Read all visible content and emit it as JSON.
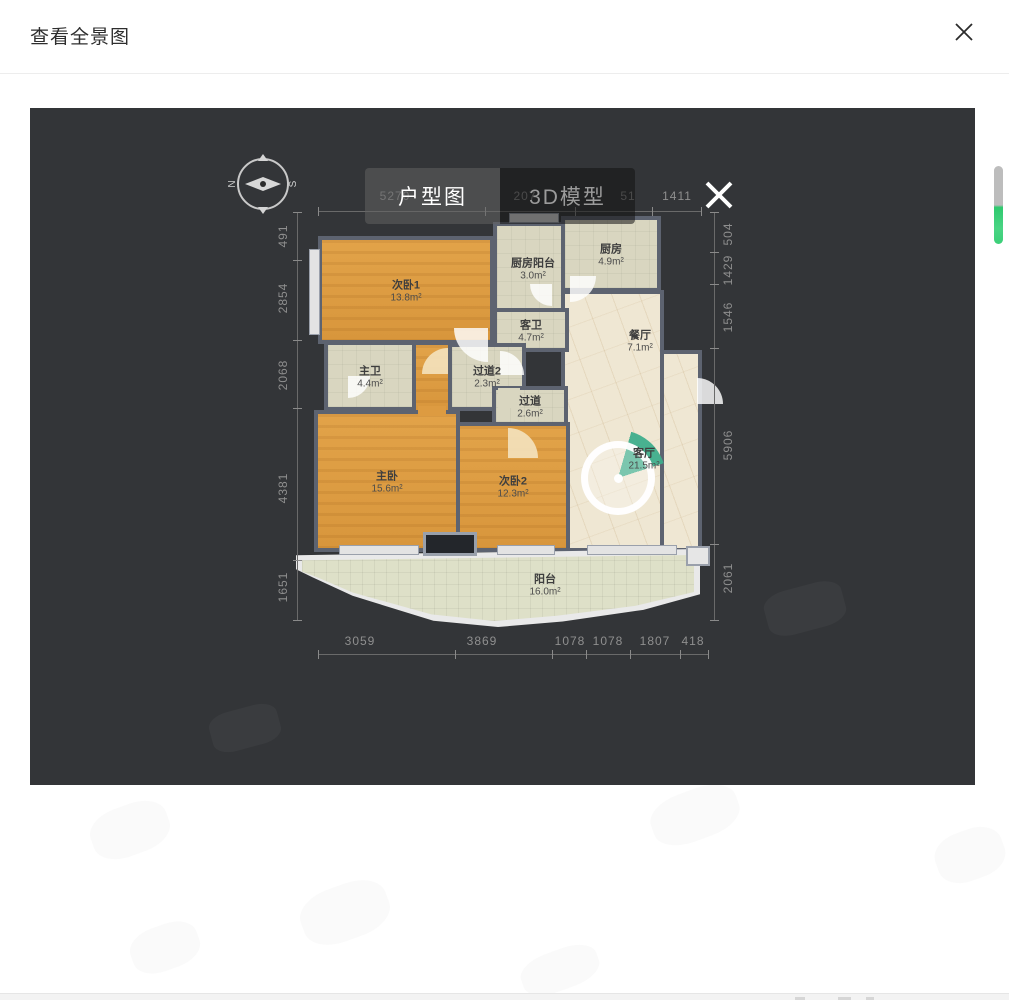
{
  "header": {
    "title": "查看全景图",
    "close_icon": "✕"
  },
  "viewer": {
    "tabs": [
      {
        "label": "户型图",
        "active": true
      },
      {
        "label": "3D模型",
        "active": false
      }
    ],
    "close_icon": "✕",
    "compass": {
      "north": "N",
      "south": "S"
    },
    "floorplan": {
      "rooms": [
        {
          "name": "次卧1",
          "area": "13.8m²",
          "floor": "wood"
        },
        {
          "name": "厨房阳台",
          "area": "3.0m²",
          "floor": "tile"
        },
        {
          "name": "厨房",
          "area": "4.9m²",
          "floor": "tile"
        },
        {
          "name": "客卫",
          "area": "4.7m²",
          "floor": "tile"
        },
        {
          "name": "餐厅",
          "area": "7.1m²",
          "floor": "marble"
        },
        {
          "name": "主卫",
          "area": "4.4m²",
          "floor": "tile"
        },
        {
          "name": "过道2",
          "area": "2.3m²",
          "floor": "tile"
        },
        {
          "name": "过道",
          "area": "2.6m²",
          "floor": "tile"
        },
        {
          "name": "主卧",
          "area": "15.6m²",
          "floor": "wood"
        },
        {
          "name": "次卧2",
          "area": "12.3m²",
          "floor": "wood"
        },
        {
          "name": "客厅",
          "area": "21.5m²",
          "floor": "marble"
        },
        {
          "name": "阳台",
          "area": "16.0m²",
          "floor": "balcony"
        }
      ],
      "dimensions": {
        "top": [
          "5270",
          "207",
          "51",
          "1411"
        ],
        "right": [
          "504",
          "1429",
          "1546",
          "5906",
          "2061"
        ],
        "bottom": [
          "3059",
          "3869",
          "1078",
          "1078",
          "1807",
          "418"
        ],
        "left": [
          "491",
          "2854",
          "2068",
          "4381",
          "1651"
        ]
      }
    },
    "colors": {
      "panel_bg": "#333538",
      "wall": "#5d6370",
      "wood_floor": "#dd9b41",
      "tile_floor": "#d9d6c0",
      "marble_floor": "#efe7d3",
      "balcony_floor": "#dee0c8",
      "pano_fan": "#3fae8c",
      "scroll_green": "#2fc96e"
    }
  }
}
